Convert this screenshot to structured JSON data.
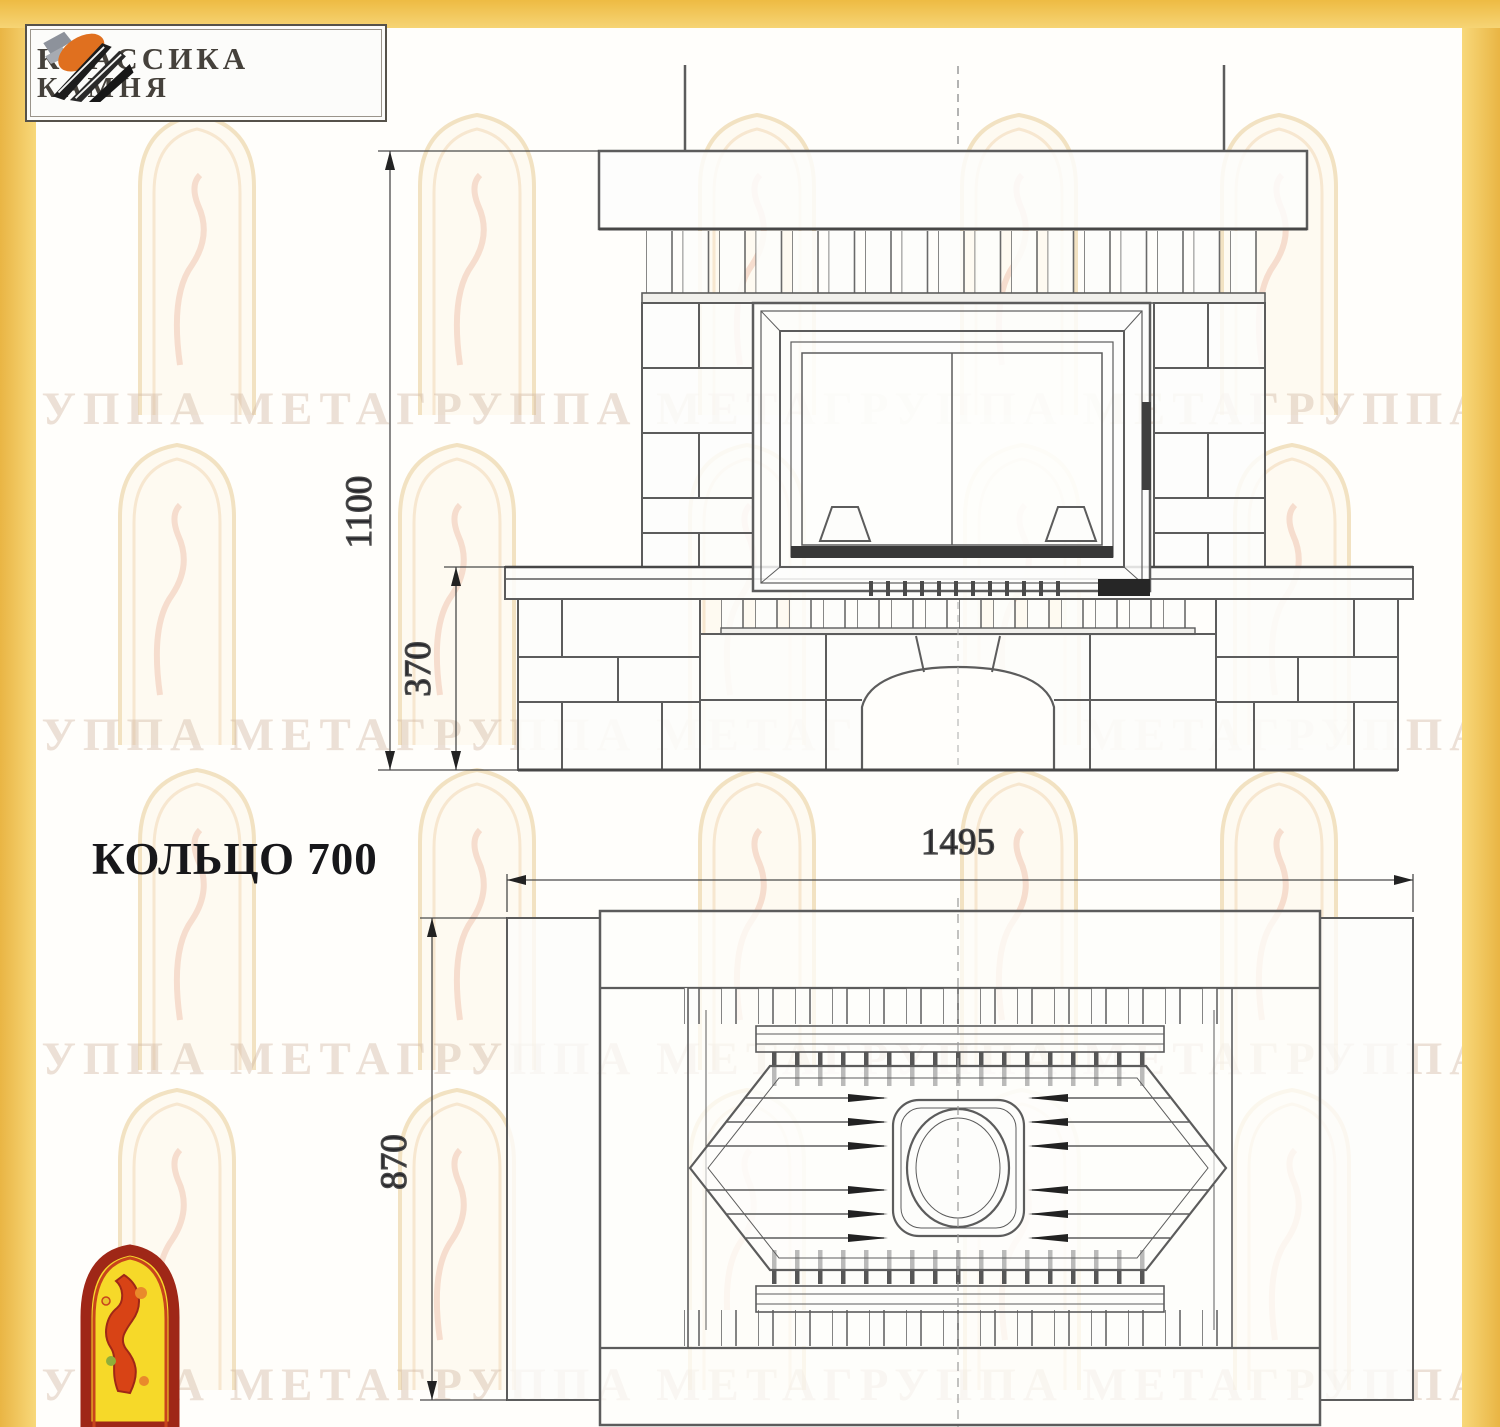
{
  "title": "КОЛЬЦО 700",
  "logo": {
    "line1": "КЛАССИКА",
    "line2": "КАМНЯ"
  },
  "dimensions": {
    "front_height": "1100",
    "base_height": "370",
    "plan_width": "1495",
    "plan_depth": "870"
  },
  "watermark": {
    "text": "ГРУППА МЕТАГРУППА МЕТАГРУППА МЕТАГРУППА МЕТА"
  },
  "colors": {
    "accent_yellow": "#f0c14c",
    "drawing_line": "#5c5c5c",
    "dark_fill": "#2b2b2b",
    "emblem_red": "#a3261e",
    "emblem_yellow": "#f6d929",
    "logo_orange": "#e0701f"
  }
}
